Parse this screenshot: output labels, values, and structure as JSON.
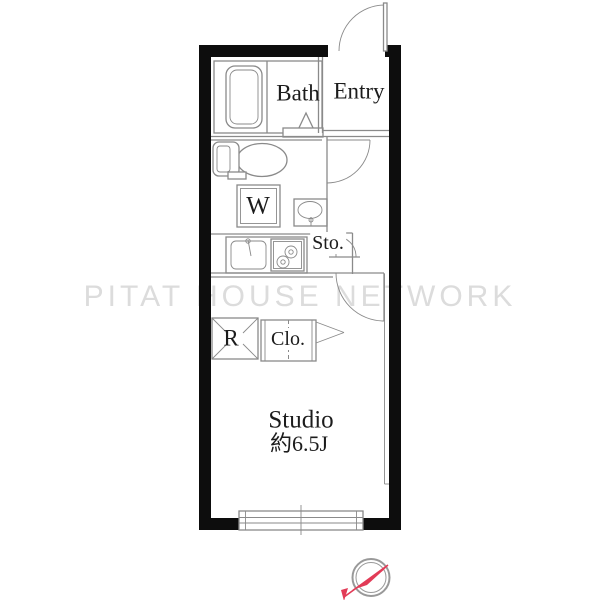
{
  "floorplan": {
    "watermark": "PITAT HOUSE NETWORK",
    "rooms": {
      "bath": "Bath",
      "entry": "Entry",
      "washer": "W",
      "storage": "Sto.",
      "refrigerator": "R",
      "closet": "Clo.",
      "studio_name": "Studio",
      "studio_size": "約6.5J"
    },
    "fixtures": [
      "bathtub",
      "toilet",
      "washbasin",
      "washing-machine-space",
      "kitchen-sink",
      "stove",
      "refrigerator-space",
      "closet",
      "sliding-window",
      "entry-door",
      "hall-door",
      "studio-door",
      "storage-door"
    ],
    "compass": {
      "type": "north-arrow",
      "needle_color": "#e23b57",
      "ring_color": "#999999"
    },
    "colors": {
      "wall": "#0d0d0d",
      "line": "#8a8a8a",
      "text": "#1c1c1c",
      "watermark": "#dcdcdc",
      "background": "#ffffff"
    }
  }
}
